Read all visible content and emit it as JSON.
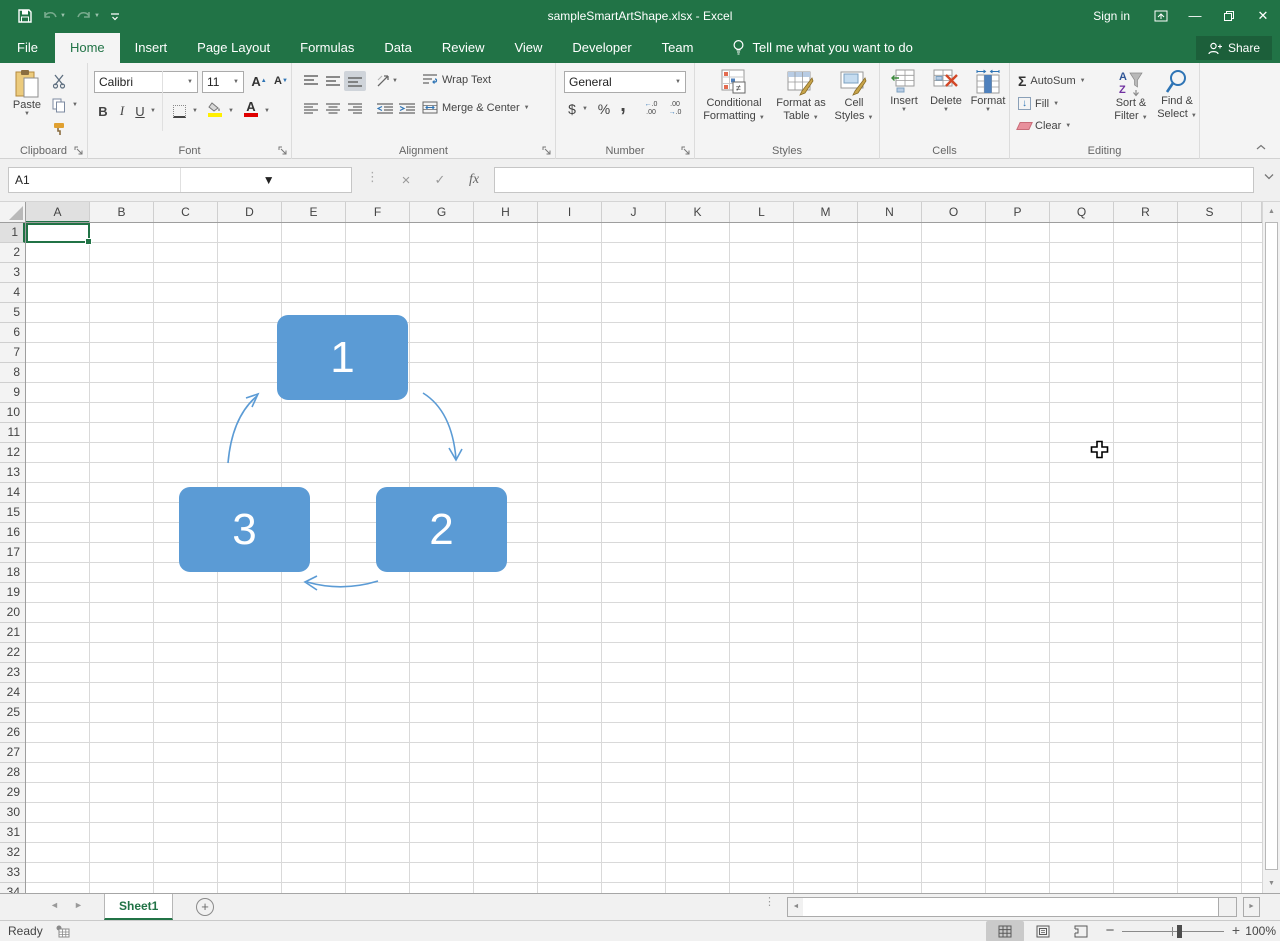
{
  "titlebar": {
    "title": "sampleSmartArtShape.xlsx - Excel",
    "sign_in": "Sign in"
  },
  "tabs": {
    "items": [
      {
        "label": "File",
        "type": "file"
      },
      {
        "label": "Home",
        "active": true
      },
      {
        "label": "Insert"
      },
      {
        "label": "Page Layout"
      },
      {
        "label": "Formulas"
      },
      {
        "label": "Data"
      },
      {
        "label": "Review"
      },
      {
        "label": "View"
      },
      {
        "label": "Developer"
      },
      {
        "label": "Team"
      }
    ],
    "tell_me": "Tell me what you want to do",
    "share": "Share"
  },
  "ribbon": {
    "clipboard": {
      "label": "Clipboard",
      "paste": "Paste"
    },
    "font": {
      "label": "Font",
      "family": "Calibri",
      "size": "11",
      "bold": "B",
      "italic": "I",
      "underline": "U"
    },
    "alignment": {
      "label": "Alignment",
      "wrap_text": "Wrap Text",
      "merge_center": "Merge & Center"
    },
    "number": {
      "label": "Number",
      "format": "General",
      "currency": "$",
      "percent": "%",
      "comma": ","
    },
    "styles": {
      "label": "Styles",
      "items": [
        {
          "line1": "Conditional",
          "line2": "Formatting"
        },
        {
          "line1": "Format as",
          "line2": "Table"
        },
        {
          "line1": "Cell",
          "line2": "Styles"
        }
      ]
    },
    "cells": {
      "label": "Cells",
      "items": [
        {
          "label": "Insert"
        },
        {
          "label": "Delete"
        },
        {
          "label": "Format"
        }
      ]
    },
    "editing": {
      "label": "Editing",
      "autosum": "AutoSum",
      "fill": "Fill",
      "clear": "Clear",
      "sort_filter_1": "Sort &",
      "sort_filter_2": "Filter",
      "find_select_1": "Find &",
      "find_select_2": "Select"
    }
  },
  "formula_bar": {
    "name_box": "A1",
    "fx": "fx",
    "formula_value": ""
  },
  "grid": {
    "columns": [
      "A",
      "B",
      "C",
      "D",
      "E",
      "F",
      "G",
      "H",
      "I",
      "J",
      "K",
      "L",
      "M",
      "N",
      "O",
      "P",
      "Q",
      "R",
      "S"
    ],
    "row_count": 34,
    "selected_column": "A",
    "selected_row": 1,
    "selected_cell": "A1"
  },
  "smartart": {
    "type": "cycle-diagram",
    "fill_color": "#5B9BD5",
    "shapes": [
      {
        "label": "1"
      },
      {
        "label": "2"
      },
      {
        "label": "3"
      }
    ]
  },
  "sheet_tabs": {
    "active": "Sheet1"
  },
  "status_bar": {
    "mode": "Ready",
    "zoom_level": "100%"
  }
}
